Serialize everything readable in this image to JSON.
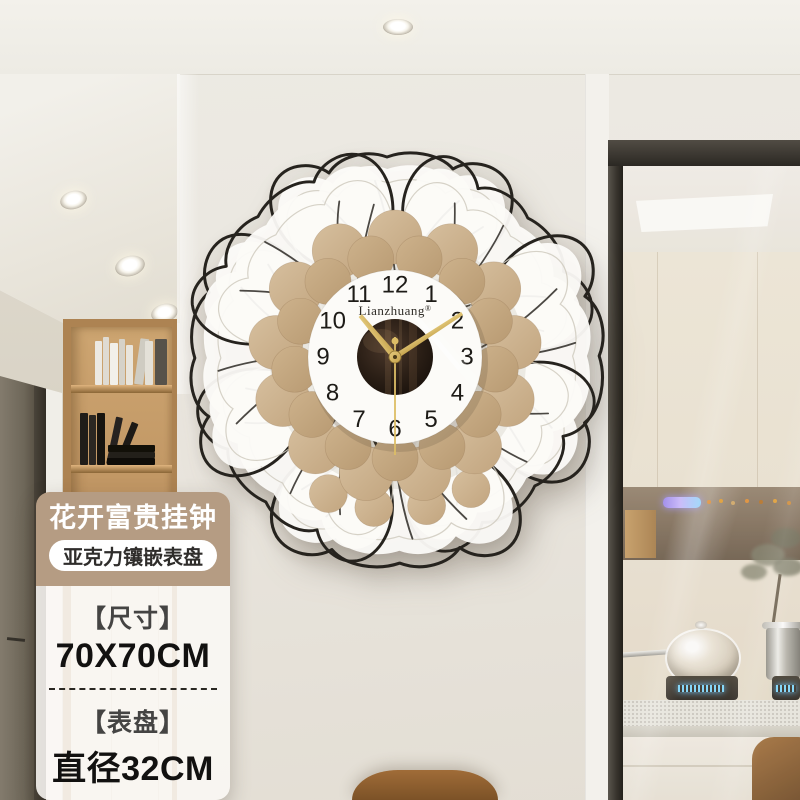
{
  "product_card": {
    "title": "花开富贵挂钟",
    "pill": "亚克力镶嵌表盘",
    "specs": [
      {
        "label": "【尺寸】",
        "value": "70X70CM"
      },
      {
        "label": "【表盘】",
        "value": "直径32CM"
      }
    ]
  },
  "clock": {
    "brand": "Lianzhuang",
    "brand_mark": "®",
    "numerals": [
      "12",
      "1",
      "2",
      "3",
      "4",
      "5",
      "6",
      "7",
      "8",
      "9",
      "10",
      "11"
    ],
    "hands": {
      "hour_deg": -40,
      "minute_deg": 57,
      "second_deg": 180
    }
  },
  "theme": {
    "badge_bg": "#b59c83",
    "badge_text": "#ffffff",
    "pill_bg": "#ffffff",
    "pill_text": "#2f2d2b",
    "spec_label": "#454443",
    "spec_value": "#121110",
    "wall": "#eae7e0",
    "wire": "#26231e",
    "wood_light": "#d6bf9e",
    "wood_dark": "#b89a72",
    "gold_light": "#e6cc7e",
    "gold_dark": "#c3a04a",
    "dial": "#fcfbf8"
  }
}
